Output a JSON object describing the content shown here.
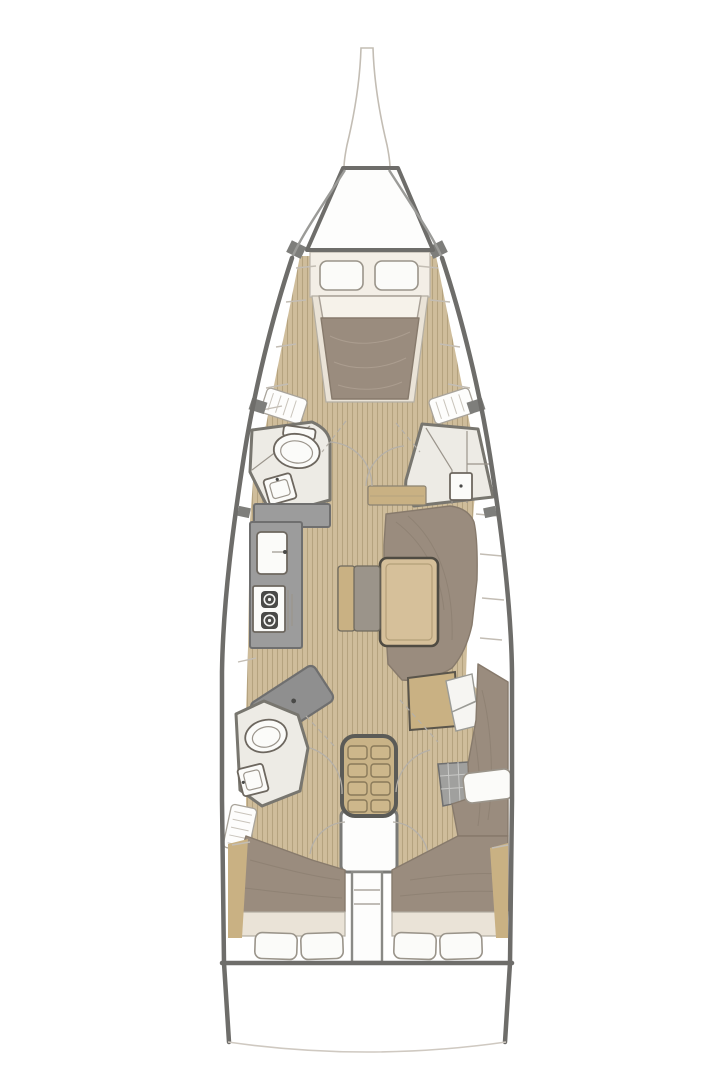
{
  "diagram": {
    "type": "yacht-interior-floor-plan",
    "orientation": "bow-at-top",
    "areas": [
      "bow-sprit",
      "anchor-locker",
      "forward-cabin-v-berth",
      "forward-head",
      "forward-shower",
      "galley",
      "nav-station",
      "salon-settee",
      "salon-table",
      "companionway-stairs",
      "engine-compartment",
      "aft-head",
      "port-aft-cabin",
      "starboard-aft-cabin",
      "stern-transom"
    ]
  },
  "colors": {
    "hull-stroke": "#6e6d6a",
    "line-light": "#c3bdb4",
    "wood": "#cfbd9b",
    "wood-stripe": "#b5a37f",
    "wood-dark": "#c9b183",
    "upholstery": "#9a8c7e",
    "upholstery-line": "#877a6c",
    "room-cream": "#edebe5",
    "bed-cream": "#f3eee6",
    "mattress": "#eae3d7",
    "counter-gray": "#9c9c9c",
    "counter-stroke": "#6f6f6f",
    "fixture-white": "#fbfbf9",
    "pillow-stroke": "#9a948a",
    "desk-gray": "#8f8f8f",
    "dark-chock": "#7e7e7b"
  }
}
